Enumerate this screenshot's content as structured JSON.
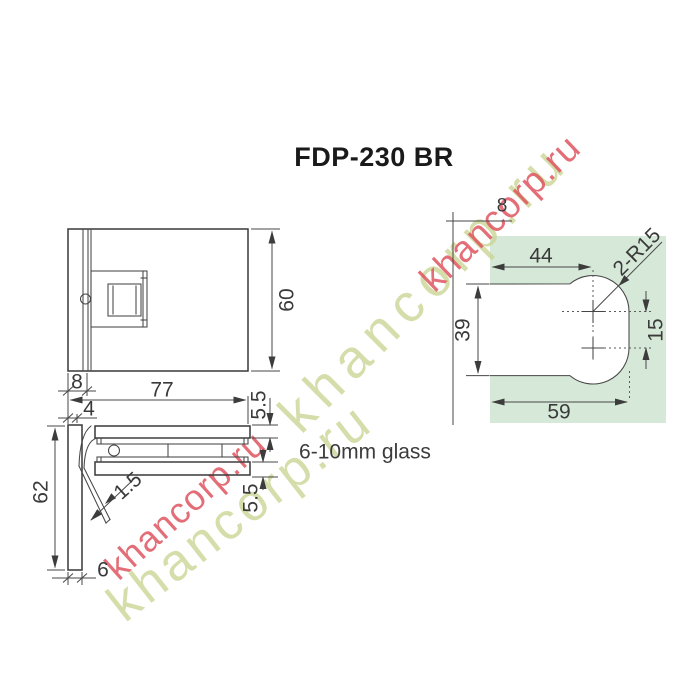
{
  "title": "FDP-230 BR",
  "glass_note": "6-10mm glass",
  "watermark": {
    "text": "khancorp.ru",
    "red": "#df5560",
    "green": "#cbd695"
  },
  "colors": {
    "glass_fill": "#d6e9d8",
    "line": "#3a3a3a"
  },
  "front_view": {
    "dims": {
      "height": "60",
      "plate_thickness": "8",
      "width": "77"
    }
  },
  "side_view": {
    "dims": {
      "offset": "4",
      "height": "62",
      "gasket_thickness": "1.5",
      "plate_thickness": "6",
      "top_plate": "5.5",
      "bottom_plate": "5.5"
    }
  },
  "cutout_view": {
    "dims": {
      "edge_offset": "8",
      "hole_center_x": "44",
      "radius": "2-R15",
      "notch_height": "39",
      "hole_spacing": "15",
      "notch_width": "59"
    }
  }
}
